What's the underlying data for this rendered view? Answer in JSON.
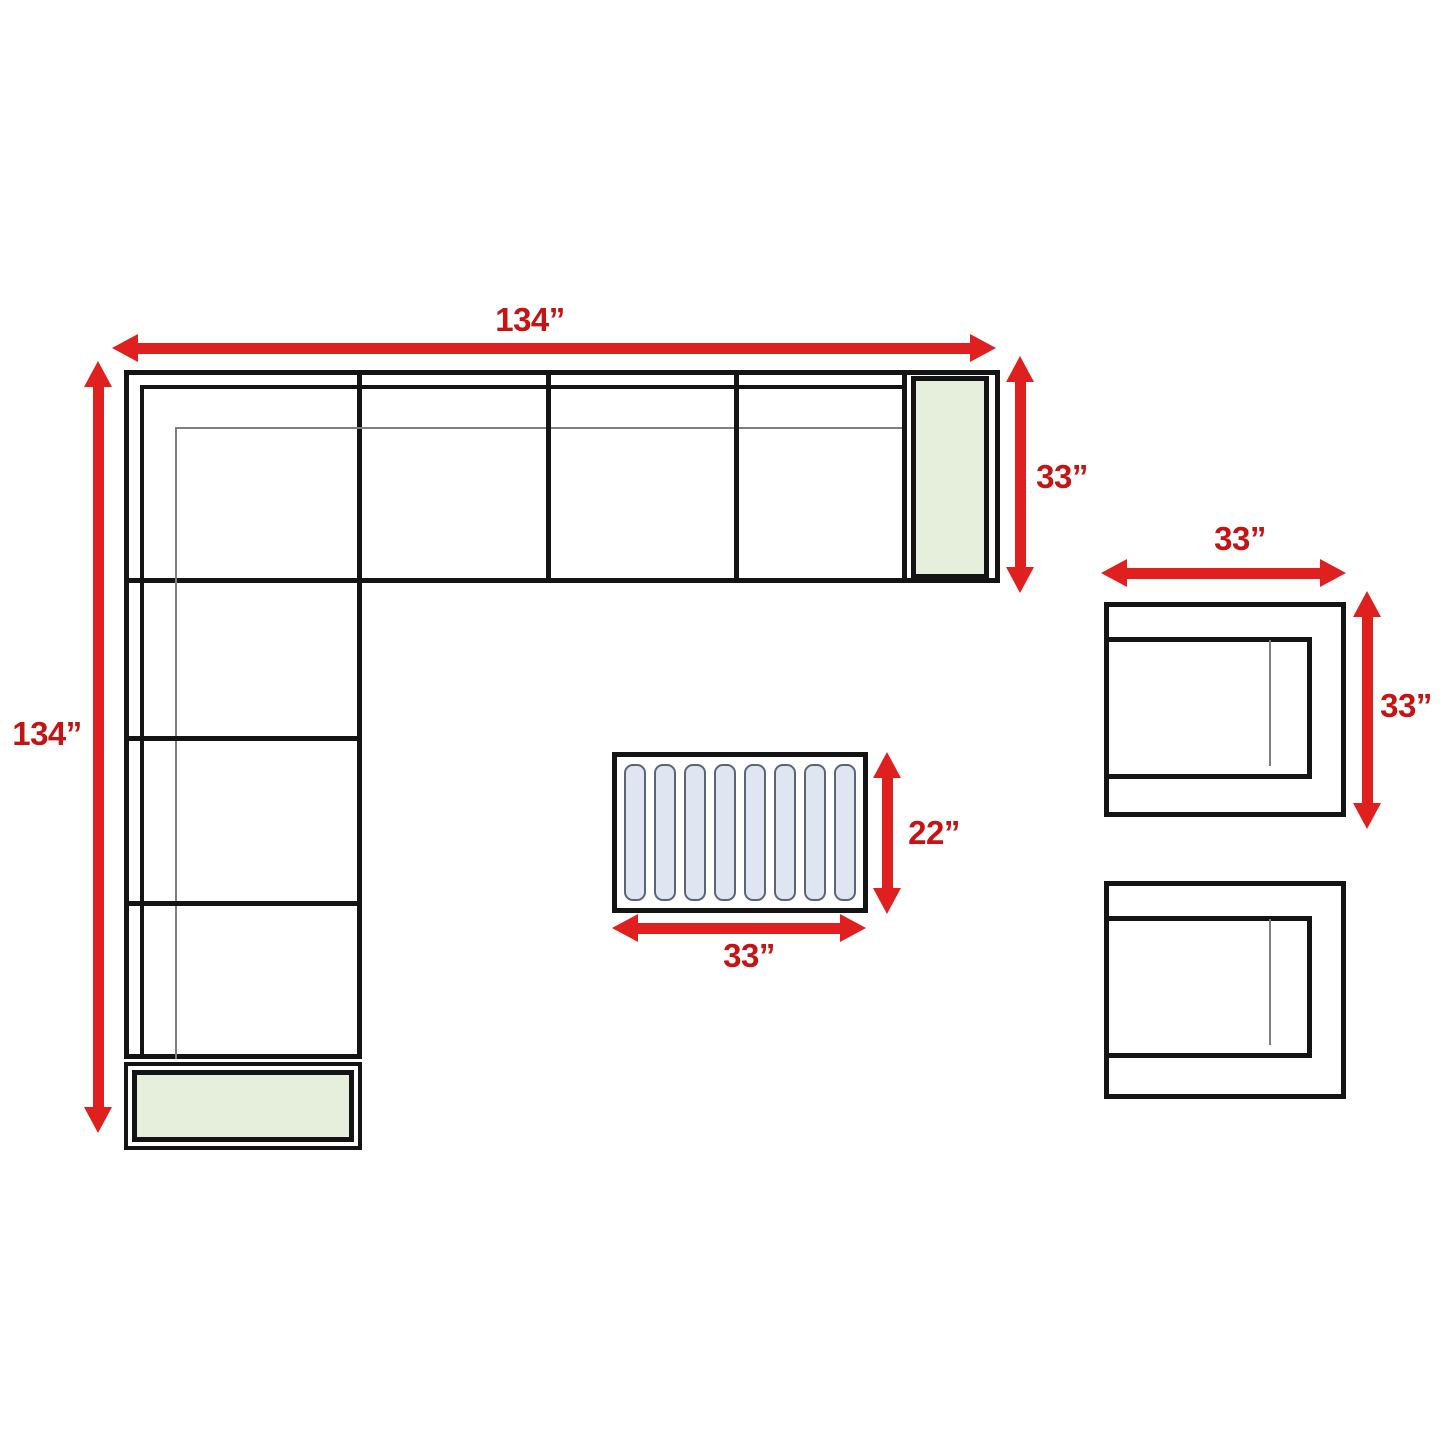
{
  "colors": {
    "arrow": "#E01F1F",
    "label": "#C41414",
    "line": "#141414",
    "thin_line": "#7F7F7F",
    "cushion_green": "#E5EFDB",
    "slat_fill": "#DFE6F2",
    "slat_border": "#5C6575",
    "background": "#FFFFFF"
  },
  "dims": {
    "sofa_width": "134”",
    "sofa_depth": "134”",
    "sofa_arm_depth": "33”",
    "chair_width": "33”",
    "chair_depth": "33”",
    "table_depth": "22”",
    "table_width": "33”"
  },
  "furniture": {
    "sectional_seats_top": 4,
    "sectional_seats_left": 3,
    "coffee_table_slats": 8,
    "chairs": 2
  }
}
